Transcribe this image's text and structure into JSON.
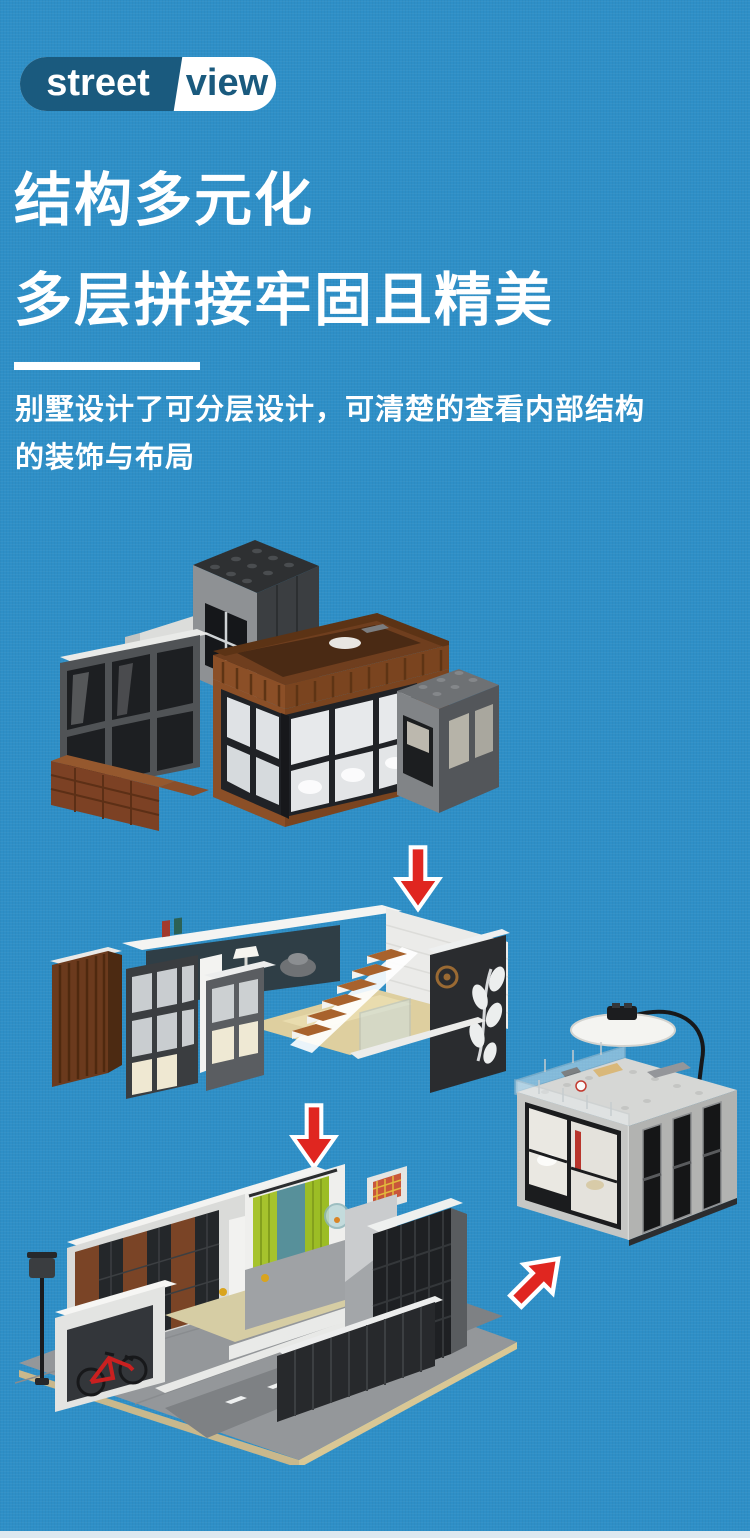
{
  "page": {
    "background_color": "#2E8FC7",
    "bottom_strip_color": "#DEE8EF"
  },
  "logo": {
    "text_left": "street",
    "text_right": "view",
    "badge_dark_color": "#1A5A7E",
    "badge_light_color": "#FFFFFF"
  },
  "headline": {
    "line1": "结构多元化",
    "line2": "多层拼接牢固且精美"
  },
  "description": {
    "lines": [
      "别墅设计了可分层设计，可清楚的查看内部结构",
      "的装饰与布局"
    ]
  },
  "flow": {
    "arrow_color": "#E02620",
    "steps": [
      {
        "figure": "villa-exterior-assembled"
      },
      {
        "figure": "upper-floor-interior-layer"
      },
      {
        "figure": "ground-floor-interior-layer"
      },
      {
        "figure": "detached-room-module"
      }
    ]
  }
}
